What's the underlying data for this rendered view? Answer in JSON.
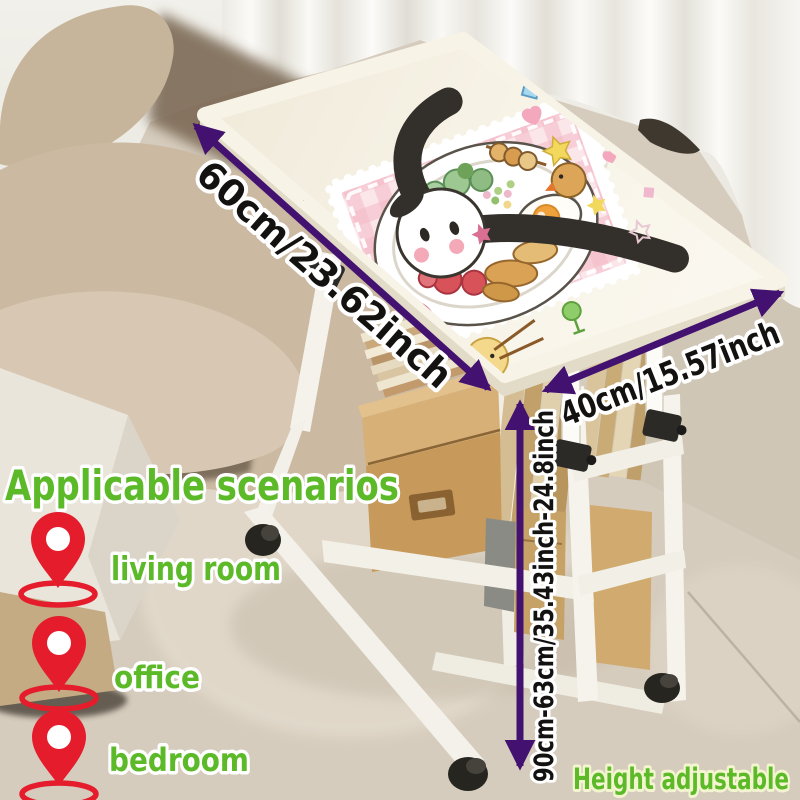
{
  "product_scene": {
    "description": "bedside movable table with cartoon tabletop in living room",
    "props": [
      "sofa",
      "curtain",
      "carpet",
      "storage-shelves",
      "caster-wheels"
    ]
  },
  "dimensions": {
    "length_label": "60cm/23.62inch",
    "width_label": "40cm/15.57inch",
    "height_label": "90cm-63cm/35.43inch-24.8inch"
  },
  "scenarios": {
    "heading": "Applicable scenarios",
    "items": [
      {
        "icon": "location-pin-icon",
        "label": "living room"
      },
      {
        "icon": "location-pin-icon",
        "label": "office"
      },
      {
        "icon": "location-pin-icon",
        "label": "bedroom"
      }
    ]
  },
  "footer": {
    "height_adjustable_label": "Height adjustable"
  },
  "colors": {
    "accent_green": "#5cba29",
    "arrow_purple": "#431270",
    "pin_red": "#e41c2c",
    "dimension_text": "#131211",
    "tabletop_cream": "#f7f3e7",
    "kraft_box": "#c79a5c"
  }
}
